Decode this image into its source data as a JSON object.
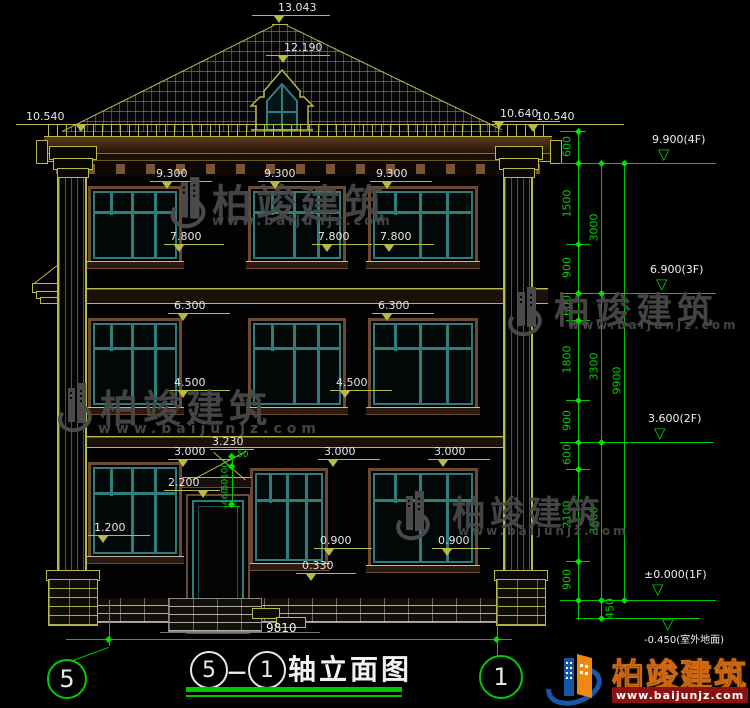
{
  "drawing": {
    "roof": {
      "peak_elev": "13.043",
      "dormer_elev": "12.190",
      "eave_left": "10.540",
      "eave_right_a": "10.640",
      "eave_right_b": "10.540"
    },
    "f3": {
      "top_a": "9.300",
      "top_b": "9.300",
      "top_c": "9.300",
      "sill_a": "7.800",
      "sill_b": "7.800",
      "sill_c": "7.800"
    },
    "f2": {
      "top_a": "6.300",
      "top_b": "6.300",
      "sill_a": "4.500",
      "sill_b": "4.500"
    },
    "f1": {
      "top_a": "3.000",
      "top_b": "3.000",
      "top_c": "3.000",
      "canopy": "3.230",
      "door_top": "2.200",
      "sill_a": "1.200",
      "sill_b": "0.900",
      "sill_c": "0.900",
      "porch": "0.330",
      "mini_a": "50",
      "mini_b": "100",
      "mini_c": "50",
      "mini_d": "460"
    },
    "total_width": "9810"
  },
  "right_dims": {
    "s600a": "600",
    "s1500": "1500",
    "s900a": "900",
    "s600b": "600",
    "s1800": "1800",
    "s900b": "900",
    "s600c": "600",
    "s2100": "2100",
    "s900c": "900",
    "s450": "450",
    "t3000": "3000",
    "t3300": "3300",
    "t3600": "3600",
    "total": "9900"
  },
  "elevations": {
    "f4": "9.900(4F)",
    "f3": "6.900(3F)",
    "f2": "3.600(2F)",
    "f1": "±0.000(1F)",
    "ground": "-0.450(室外地面)"
  },
  "axes": {
    "left": "5",
    "right": "1"
  },
  "title": {
    "axis_a": "5",
    "sep": "－",
    "axis_b": "1",
    "name": "轴立面图"
  },
  "watermark": {
    "brand": "柏竣建筑",
    "url": "www.baijunjz.com"
  },
  "logo": {
    "brand": "柏竣建筑",
    "url": "www.baijunjz.com"
  },
  "colors": {
    "line_yellow": "#b9b944",
    "dim_green": "#00cc00",
    "text_white": "#e8e8e8",
    "frame_brown": "#6b4a33",
    "frame_teal": "#2e7d7d",
    "watermark_gray": "#4a4a4a",
    "logo_blue": "#1558a8",
    "logo_orange": "#f0880f",
    "logo_red_bar": "#8c1212"
  }
}
